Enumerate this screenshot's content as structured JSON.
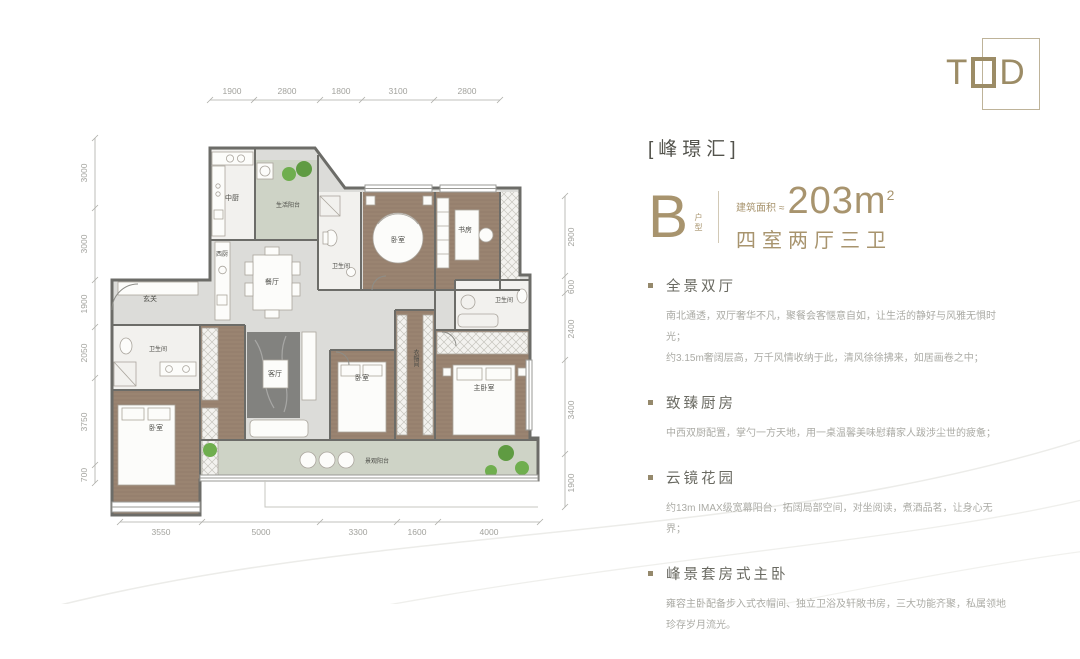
{
  "header": {
    "project": "[峰璟汇]"
  },
  "logo": {
    "letter_t": "T",
    "letter_d": "D"
  },
  "unit": {
    "type_letter": "B",
    "type_label": "户型",
    "area_label": "建筑面积",
    "area_approx": "≈",
    "area_value": "203m",
    "area_sup": "2",
    "rooms_summary": "四室两厅三卫"
  },
  "features": [
    {
      "title": "全景双厅",
      "lines": [
        "南北通透，双厅奢华不凡，聚餐会客惬意自如，让生活的静好与风雅无惧时光；",
        "约3.15m奢阔层高，万千风情收纳于此，清风徐徐拂来，如居画卷之中；"
      ]
    },
    {
      "title": "致臻厨房",
      "lines": [
        "中西双厨配置，掌勺一方天地，用一桌温馨美味慰藉家人跋涉尘世的疲惫；"
      ]
    },
    {
      "title": "云镜花园",
      "lines": [
        "约13m IMAX级宽幕阳台，拓阔局部空间，对坐阅读，煮酒品茗，让身心无界；"
      ]
    },
    {
      "title": "峰景套房式主卧",
      "lines": [
        "雍容主卧配备步入式衣帽间、独立卫浴及轩敞书房，三大功能齐聚，私属领地珍存岁月流光。"
      ]
    }
  ],
  "floorplan": {
    "dims_top": [
      "1900",
      "2800",
      "1800",
      "3100",
      "2800"
    ],
    "dims_left": [
      "3000",
      "3000",
      "1900",
      "2050",
      "3750",
      "700"
    ],
    "dims_right": [
      "2900",
      "600",
      "2400",
      "3400",
      "1900"
    ],
    "dims_bottom": [
      "3550",
      "5000",
      "3300",
      "1600",
      "4000"
    ],
    "rooms": [
      {
        "name": "中厨"
      },
      {
        "name": "生活阳台"
      },
      {
        "name": "餐厅"
      },
      {
        "name": "西厨"
      },
      {
        "name": "玄关"
      },
      {
        "name": "卫生间"
      },
      {
        "name": "卧室"
      },
      {
        "name": "书房"
      },
      {
        "name": "卫生间"
      },
      {
        "name": "卫生间"
      },
      {
        "name": "卧室"
      },
      {
        "name": "客厅"
      },
      {
        "name": "卧室"
      },
      {
        "name": "衣帽间"
      },
      {
        "name": "主卧室"
      },
      {
        "name": "景观阳台"
      }
    ]
  },
  "colors": {
    "accent": "#a8946e",
    "wall": "#6c6c68",
    "wood": "#9a8471",
    "balcony": "#ced3c6",
    "floor": "#dcdcd9"
  }
}
